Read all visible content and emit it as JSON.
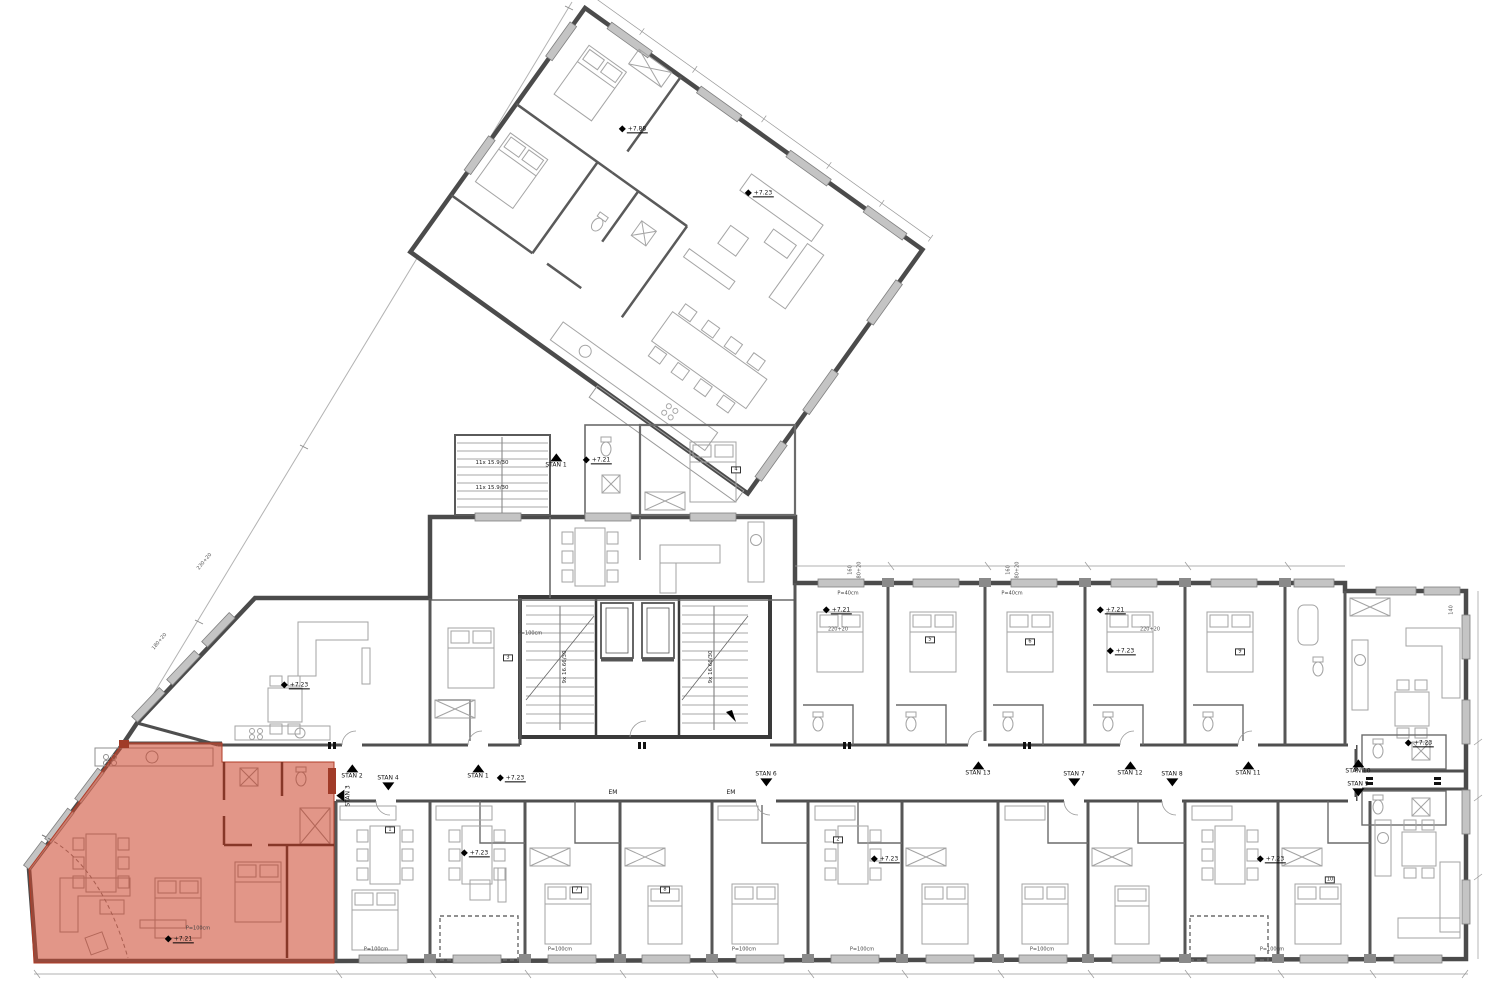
{
  "meta": {
    "drawing_type": "apartment-building-floor-plan",
    "highlight_color": "#cd4a32",
    "wall_color": "#4b4b4b",
    "level_elevations_visible": [
      "+7.21",
      "+7.23",
      "+7.88"
    ],
    "apartments_visible": [
      "STAN 1",
      "STAN 2",
      "STAN 3",
      "STAN 4",
      "STAN 6",
      "STAN 7",
      "STAN 8",
      "STAN 9",
      "STAN 10",
      "STAN 11",
      "STAN 12",
      "STAN 13"
    ]
  },
  "labels": {
    "markers": [
      {
        "t": "STAN 2"
      },
      {
        "t": "STAN 3"
      },
      {
        "t": "STAN 4"
      },
      {
        "t": "STAN 1"
      },
      {
        "t": "STAN 1"
      },
      {
        "t": "STAN 6"
      },
      {
        "t": "STAN 13"
      },
      {
        "t": "STAN 7"
      },
      {
        "t": "STAN 12"
      },
      {
        "t": "STAN 8"
      },
      {
        "t": "STAN 11"
      },
      {
        "t": "STAN 10"
      },
      {
        "t": "STAN 9"
      }
    ],
    "em": [
      {
        "t": "EM"
      },
      {
        "t": "EM"
      }
    ],
    "elevations": [
      {
        "t": "+7.23"
      },
      {
        "t": "+7.23"
      },
      {
        "t": "+7.21"
      },
      {
        "t": "+7.88"
      },
      {
        "t": "+7.23"
      },
      {
        "t": "+7.23"
      },
      {
        "t": "+7.21"
      },
      {
        "t": "+7.21"
      },
      {
        "t": "+7.23"
      },
      {
        "t": "+7.23"
      },
      {
        "t": "+7.23"
      },
      {
        "t": "+7.23"
      },
      {
        "t": "+7.21"
      }
    ],
    "stairs": [
      {
        "t": "11x 15.9/30"
      },
      {
        "t": "11x 15.9/30"
      },
      {
        "t": "9x 16.66/30"
      },
      {
        "t": "9x 16.66/30"
      }
    ],
    "sills": [
      {
        "t": "P=100cm"
      },
      {
        "t": "P=100cm"
      },
      {
        "t": "P=100cm"
      },
      {
        "t": "P=100cm"
      },
      {
        "t": "P=100cm"
      },
      {
        "t": "P=100cm"
      },
      {
        "t": "P=100cm"
      },
      {
        "t": "P=100cm"
      },
      {
        "t": "P=40cm"
      },
      {
        "t": "P=40cm"
      }
    ],
    "dims": [
      {
        "t": "160"
      },
      {
        "t": "80+20"
      },
      {
        "t": "160"
      },
      {
        "t": "80+20"
      },
      {
        "t": "220+20"
      },
      {
        "t": "220+20"
      },
      {
        "t": "230+20"
      },
      {
        "t": "180+20"
      },
      {
        "t": "140"
      }
    ],
    "tags": [
      {
        "t": "1"
      },
      {
        "t": "2"
      },
      {
        "t": "3"
      },
      {
        "t": "4"
      },
      {
        "t": "5"
      },
      {
        "t": "6"
      },
      {
        "t": "7"
      },
      {
        "t": "8"
      },
      {
        "t": "9"
      },
      {
        "t": "10"
      }
    ]
  }
}
